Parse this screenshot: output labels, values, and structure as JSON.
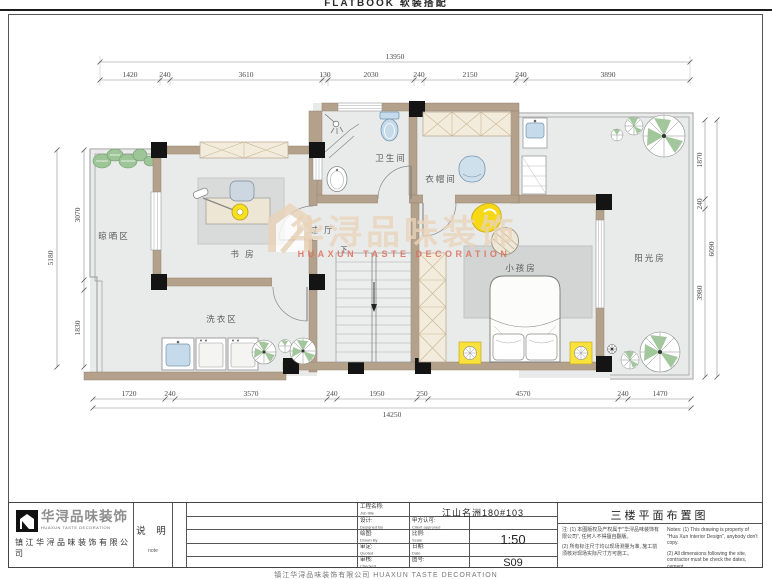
{
  "banners": {
    "top": "FLATBOOK 软装搭配",
    "bottom": "镇江华浔品味装饰有限公司 HUAXUN TASTE DECORATION"
  },
  "plan": {
    "rooms": {
      "drying": "晾晒区",
      "study": "书 房",
      "laundry": "洗衣区",
      "bathroom": "卫生间",
      "cloakroom": "衣帽间",
      "hallway": "过 厅",
      "kids_room": "小孩房",
      "sunroom": "阳光房",
      "stairs_down": "下"
    },
    "watermark": {
      "cn": "华浔品味装饰",
      "en": "HUAXUN TASTE DECORATION"
    },
    "dims": {
      "top_total": "13950",
      "top": [
        "1420",
        "240",
        "3610",
        "130",
        "2030",
        "240",
        "2150",
        "240",
        "3890"
      ],
      "bottom_total": "14250",
      "bottom": [
        "1720",
        "240",
        "3570",
        "240",
        "1950",
        "250",
        "4570",
        "240",
        "1470"
      ],
      "left_total": "5180",
      "left": [
        "3070",
        "1830"
      ],
      "right_total": "6090",
      "right": [
        "1870",
        "240",
        "3980"
      ]
    }
  },
  "titleblock": {
    "logo_cn": "华浔品味装饰",
    "logo_en": "HUAXUN TASTE DECORATION",
    "company": "镇江华浔品味装饰有限公司",
    "note_cn": "说 明",
    "note_en": "note",
    "r1_cn": "工程名称:",
    "r1_en": "Job title",
    "r2_cn": "设计:",
    "r2_en": "Designed By",
    "r3_cn": "绘图:",
    "r3_en": "Drawn By",
    "r4_cn": "审定:",
    "r4_en": "Quoted",
    "r5_cn": "审核:",
    "r5_en": "Checked",
    "r2b_cn": "甲方认可:",
    "r2b_en": "Client approved",
    "r3b_cn": "比例:",
    "r3b_en": "Scale",
    "r4b_cn": "日期:",
    "r4b_en": "Date",
    "r5b_cn": "图号:",
    "project": "江山名洲180#103",
    "scale_value": "1:50",
    "sheet_no": "S09",
    "drawing_title": "三楼平面布置图",
    "notes_cn_1": "注: (1) 本图版权及产权属于\"华浔品味装饰有限公司\", 任何人不得擅自翻版。",
    "notes_cn_2": "(2) 所有标注尺寸均以现场测量为准, 施工前须核对现场实际尺寸方可施工。",
    "notes_en_1": "Notes: (1) This drawing is property of \"Hua Xun Interior Design\", anybody don't copy.",
    "notes_en_2": "(2) All dimensions following the site, contractor must be check the dates, cement."
  },
  "colors": {
    "wall": "#b3a18c",
    "floor": "#e9ebea",
    "column": "#141414",
    "accent_yellow": "#f7e11c",
    "fixture_blue": "#c5dbeb",
    "plant_green": "#a3c79c",
    "watermark_tan": "#e9d4ba",
    "watermark_red": "#de6e5b"
  }
}
